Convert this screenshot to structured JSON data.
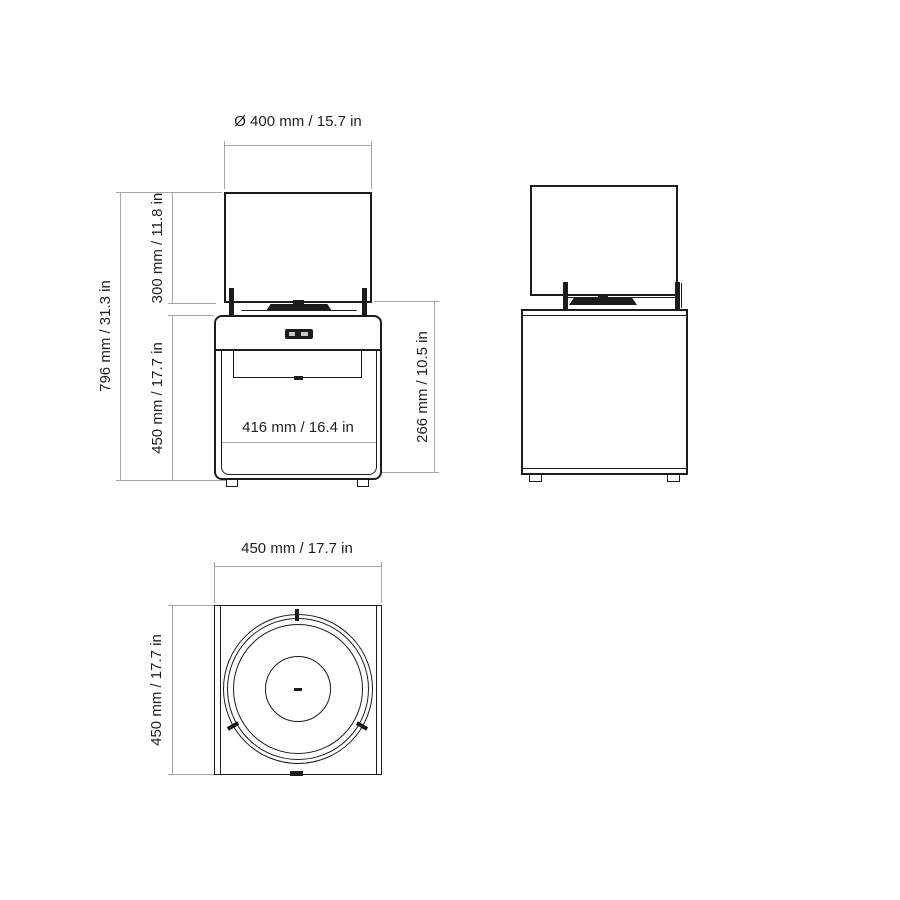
{
  "front_view": {
    "diameter_label": "Ø 400 mm / 15.7 in",
    "total_height_label": "796 mm / 31.3 in",
    "screen_height_label": "300 mm / 11.8 in",
    "base_height_label": "450 mm / 17.7 in",
    "inner_width_label": "416 mm / 16.4 in",
    "firebox_height_label": "266 mm / 10.5 in"
  },
  "top_view": {
    "width_label": "450 mm / 17.7 in",
    "depth_label": "450 mm / 17.7 in"
  },
  "colors": {
    "object_line": "#1c1c1c",
    "dimension_line": "#a6a6a6",
    "text": "#1f1f1f",
    "background": "#ffffff"
  }
}
